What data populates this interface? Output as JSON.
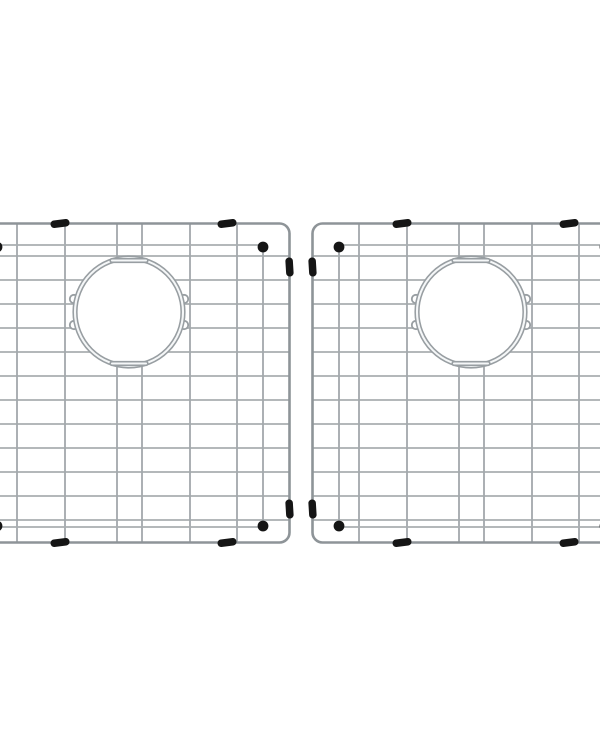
{
  "canvas": {
    "width": 600,
    "height": 750,
    "background": "#ffffff"
  },
  "colors": {
    "horizontal_wire": "#a9aeb1",
    "vertical_wire": "#a3a8ac",
    "frame_wire": "#8e9498",
    "drain_ring": "#989ea2",
    "wire_highlight": "#f5f7f8",
    "rubber_black": "#151515"
  },
  "grid_unit": {
    "width": 322,
    "height": 322,
    "frame_inset": 1.5,
    "corner_radius": 10,
    "frame_stroke": 2.6,
    "wire_stroke": 1.8,
    "rows_y": [
      34,
      58,
      82,
      106,
      130,
      154,
      178,
      202,
      226,
      250,
      274,
      298
    ],
    "cols_x": [
      48,
      96,
      148,
      173,
      221,
      268
    ],
    "drain": {
      "cx": 160,
      "cy": 90,
      "r": 54,
      "ring_stroke": 5.2,
      "core_stroke": 2.1,
      "tab_half_width": 17,
      "tab_offset": 51.5,
      "lug_offset_x": 55,
      "lug_offset_y": 13,
      "lug_r": 4.2
    },
    "standoff": {
      "top_y": 23,
      "bottom_y": 305,
      "leg_x": [
        28,
        294
      ],
      "ball_r": 5.4
    },
    "bumpers": {
      "rail_x": [
        91,
        258
      ],
      "rail_y": [
        45,
        287
      ],
      "length": 19,
      "thickness": 7.5,
      "corner": 3.5,
      "tilt_deg": -7
    }
  },
  "placement": {
    "grids_top": 222,
    "left_grid_left": -31,
    "right_grid_left": 311,
    "gap": 20
  }
}
